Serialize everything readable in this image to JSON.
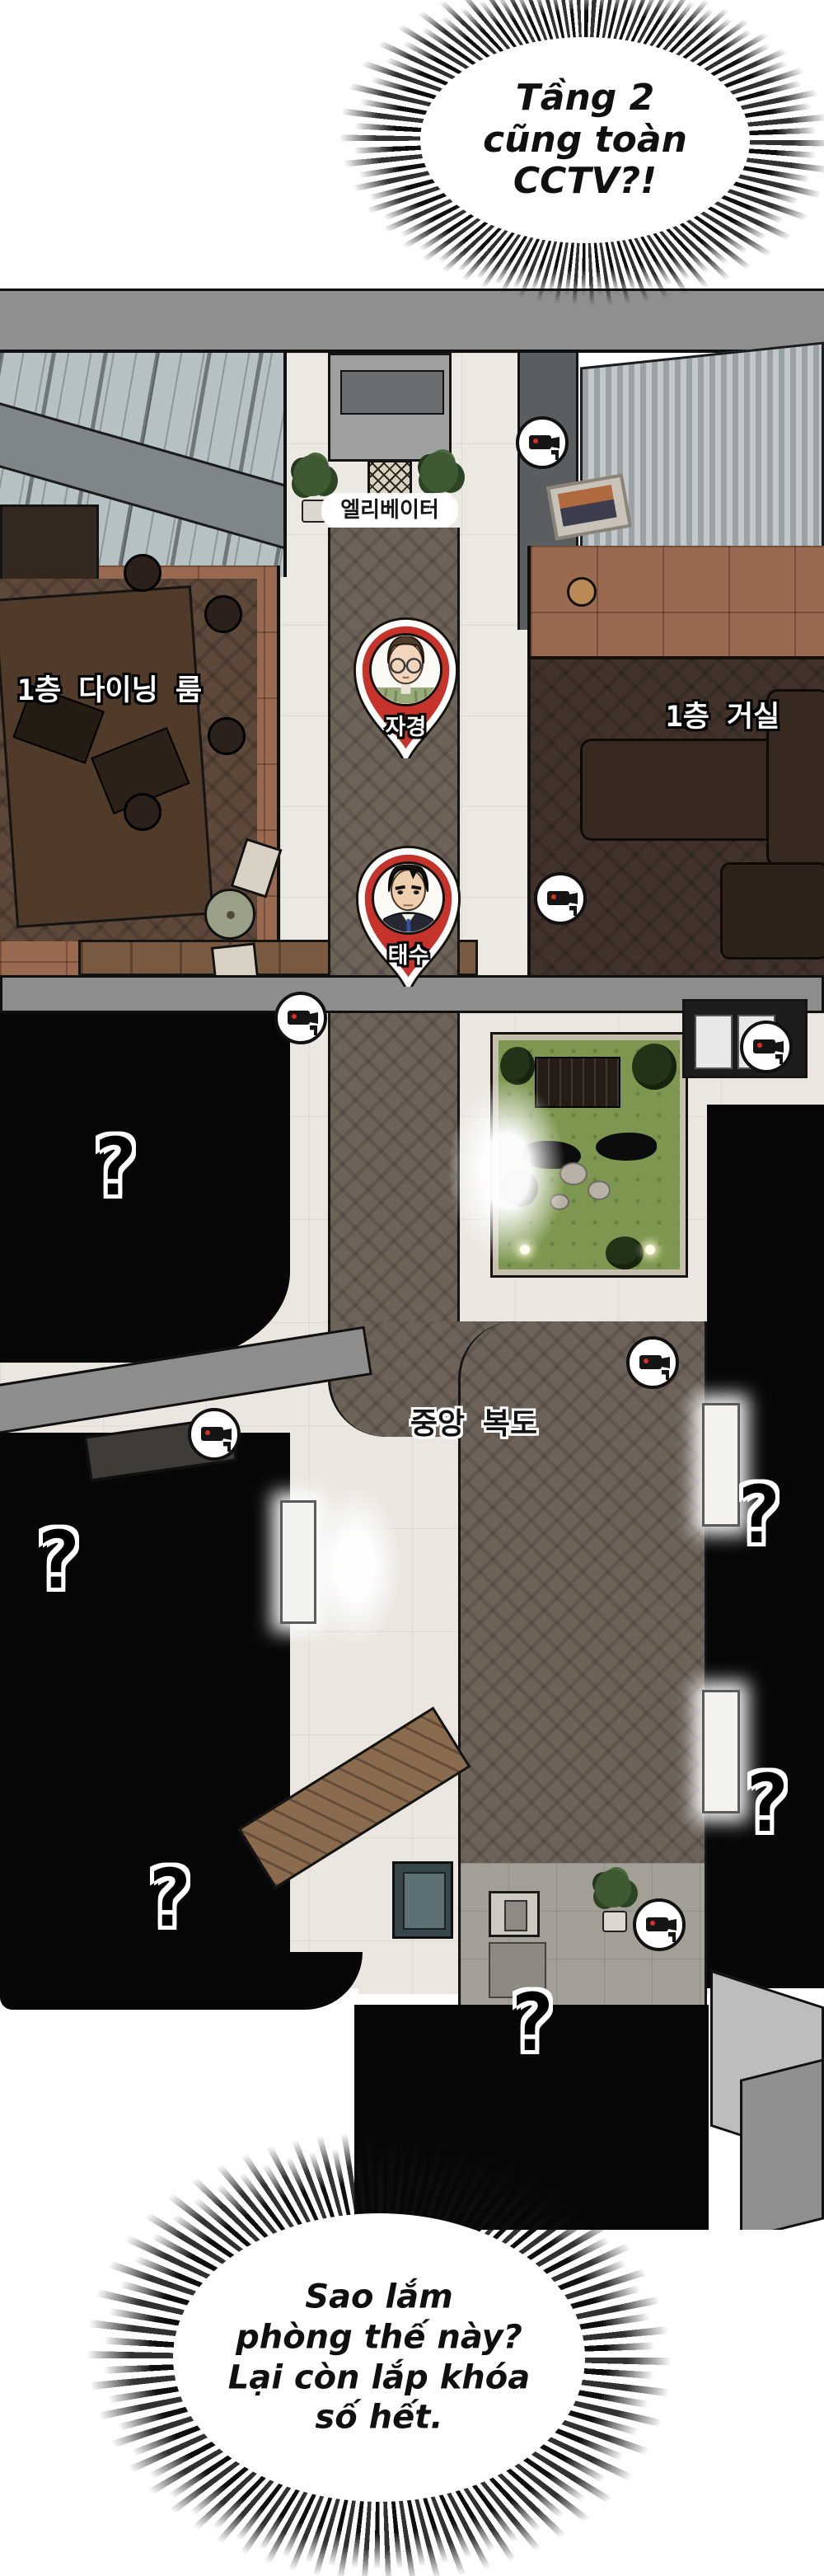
{
  "comic": {
    "top_bubble": {
      "lines": [
        "Tầng 2",
        "cũng toàn",
        "CCTV?!"
      ]
    },
    "bottom_bubble": {
      "lines": [
        "Sao lắm",
        "phòng thế này?",
        "Lại còn lắp khóa",
        "số hết."
      ]
    }
  },
  "floorplan": {
    "labels": {
      "elevator": "엘리베이터",
      "dining_line1": "1층",
      "dining_line2": "다이닝 룸",
      "living": "1층 거실",
      "corridor": "중앙 복도"
    },
    "pins": [
      {
        "label": "자경"
      },
      {
        "label": "태수"
      }
    ],
    "unknown_marker": "?",
    "icons": {
      "cctv_camera": "cctv-camera-icon",
      "question_mark": "pixel-question-mark",
      "map_pin": "character-map-pin"
    }
  },
  "colors": {
    "pin_red": "#c5332b",
    "camera_led_red": "#d93025",
    "grass_green": "#7d9750",
    "roof_gray": "#8f8f8f",
    "marble": "#ece9e2",
    "black_room": "#070707"
  }
}
